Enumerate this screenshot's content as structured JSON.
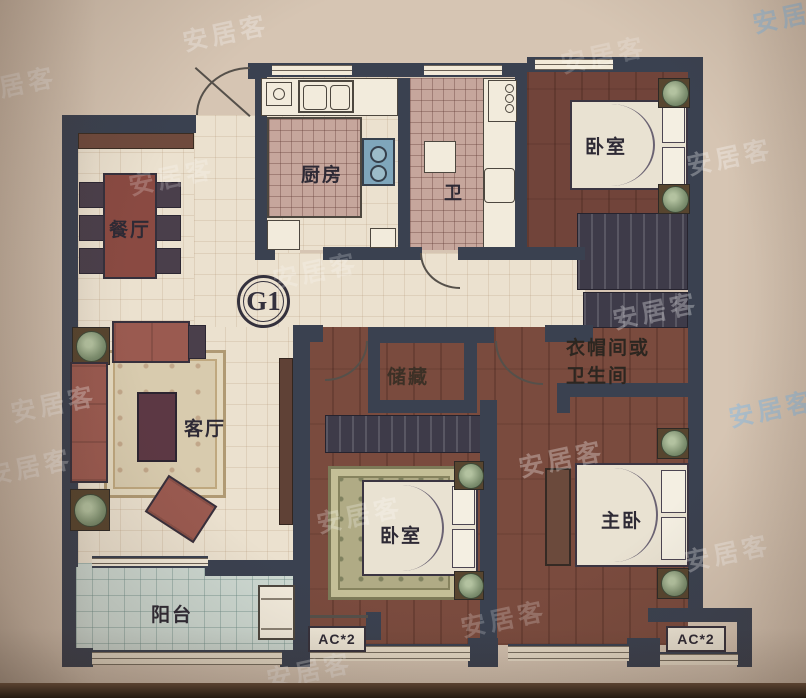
{
  "watermark": {
    "text": "安居客"
  },
  "unit_badge": {
    "label": "G1"
  },
  "rooms": {
    "dining": {
      "label": "餐厅"
    },
    "kitchen": {
      "label": "厨房"
    },
    "bath": {
      "label": "卫"
    },
    "bedroom_top": {
      "label": "卧室"
    },
    "living": {
      "label": "客厅"
    },
    "storage": {
      "label": "储藏"
    },
    "cloak_line1": {
      "label": "衣帽间或"
    },
    "cloak_line2": {
      "label": "卫生间"
    },
    "bedroom_mid": {
      "label": "卧室"
    },
    "master": {
      "label": "主卧"
    },
    "balcony": {
      "label": "阳台"
    }
  },
  "ac": {
    "left": "AC*2",
    "right": "AC*2"
  },
  "colors": {
    "wall": "#3a4150",
    "wood_floor": "#7a4b3e",
    "tile_floor": "#ebe1cf",
    "bath_tile": "#c6a69c",
    "balcony_tile": "#cdd9d2",
    "furniture_red": "#9a5a50",
    "photo_background": "#d6c5b3"
  }
}
